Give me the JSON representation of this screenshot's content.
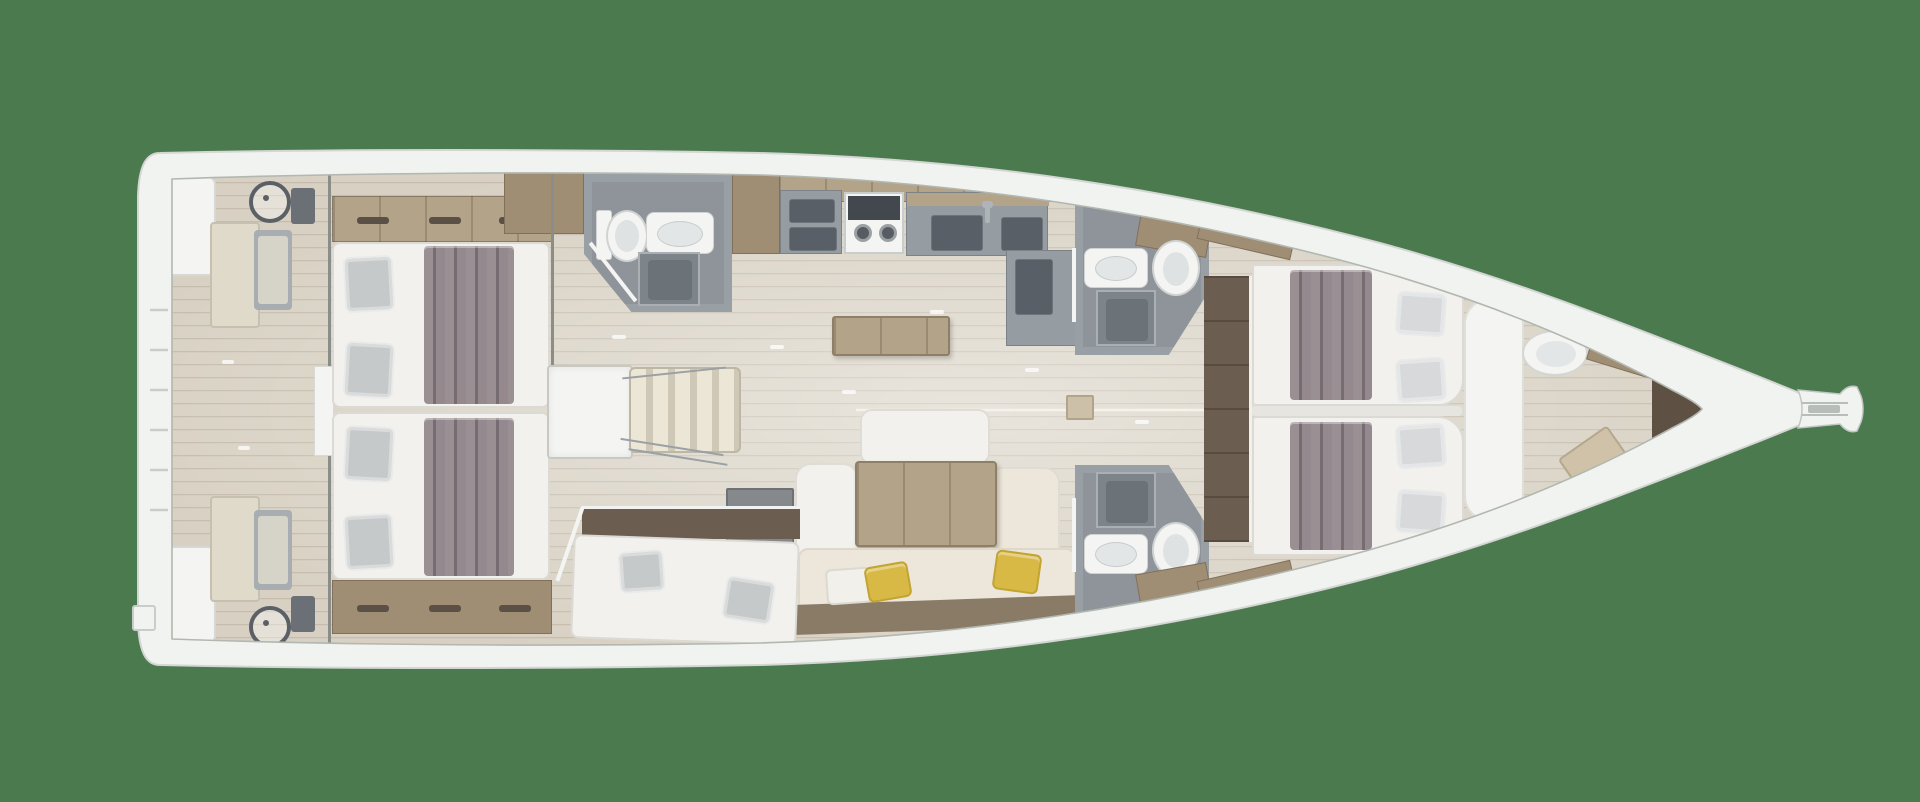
{
  "scene": {
    "type": "sailing-yacht-interior-floor-plan-top-view",
    "orientation": {
      "bow": "right",
      "stern": "left"
    },
    "background_color": "#4b7a4f"
  },
  "palette": {
    "bg-green": "#4b7a4f",
    "hull-white": "#f1f3f0",
    "deck-line": "#c7ccc6",
    "floor-base": "#d8d1c3",
    "plank": "#796a55",
    "wood-light": "#b2a389",
    "wood-mid": "#a08e74",
    "wood-dark": "#6b5d4f",
    "counter-gray": "#969da2",
    "counter-dark": "#585f66",
    "shower-gray": "#7d848a",
    "shower-inner": "#6b7278",
    "fixture-white": "#f4f5f3",
    "mattress": "#f2f1ee",
    "pillow-gray": "#c6c9ca",
    "blanket": "#8e8287",
    "sofa-white": "#f2f1ed",
    "sofa-cream": "#ece7da",
    "pillow-yellow": "#d9b945",
    "metal": "#9aa0a5",
    "wall-gray": "#99a0a5",
    "stair-light": "#ece6d6",
    "stair-dark": "#cfc8b6"
  },
  "vessel": {
    "areas": [
      {
        "id": "swim-platform",
        "fixtures": [
          "stern-locker-port",
          "stern-locker-starboard",
          "boarding-ladder",
          "transom-step"
        ]
      },
      {
        "id": "cockpit",
        "fixtures": [
          "helm-wheel-port",
          "helm-wheel-starboard",
          "helm-console-port",
          "helm-console-starboard",
          "cockpit-bench-port",
          "cockpit-bench-starboard",
          "companionway-opening"
        ]
      },
      {
        "id": "aft-cabin-port",
        "fixtures": [
          "double-bed",
          "two-gray-pillows",
          "mauve-blanket",
          "shelf-cabinet",
          "wardrobe"
        ]
      },
      {
        "id": "aft-cabin-starboard",
        "fixtures": [
          "double-bed",
          "two-gray-pillows",
          "mauve-blanket",
          "shelf-cabinet"
        ]
      },
      {
        "id": "companionway",
        "fixtures": [
          "engine-box",
          "stairs",
          "handrails"
        ]
      },
      {
        "id": "aft-head-port",
        "fixtures": [
          "toilet",
          "vanity-sink",
          "shower",
          "door"
        ]
      },
      {
        "id": "galley",
        "fixtures": [
          "cabinet-column",
          "upper-cabinet-band",
          "counter-unit",
          "two-burner-stove",
          "double-sink",
          "faucet",
          "peninsula-unit"
        ]
      },
      {
        "id": "saloon",
        "fixtures": [
          "sideboard-table",
          "dinette-table",
          "u-shaped-sofa",
          "seat-cushions",
          "white-pillow",
          "yellow-pillow-left",
          "yellow-pillow-right",
          "side-table",
          "floor-hatch",
          "centerline-seam"
        ]
      },
      {
        "id": "mid-cabin-starboard",
        "fixtures": [
          "single-berth",
          "two-gray-pillows",
          "bulkhead-wall",
          "angled-door"
        ]
      },
      {
        "id": "forward-head-port",
        "fixtures": [
          "vanity-sink",
          "toilet",
          "shower",
          "door",
          "cabinet"
        ]
      },
      {
        "id": "forward-head-starboard",
        "fixtures": [
          "vanity-sink",
          "toilet",
          "shower",
          "door",
          "cabinet"
        ]
      },
      {
        "id": "forward-cabin",
        "fixtures": [
          "twin-bed-port",
          "twin-bed-starboard",
          "white-pillows",
          "mauve-blankets",
          "dresser-walkway",
          "bow-cushion"
        ]
      },
      {
        "id": "forepeak",
        "fixtures": [
          "vanity-sink",
          "wood-counter",
          "seat-cushion",
          "locker-wedge"
        ]
      },
      {
        "id": "bow",
        "fixtures": [
          "windlass",
          "forestay-line",
          "anchor-roller-fitting"
        ]
      }
    ]
  }
}
